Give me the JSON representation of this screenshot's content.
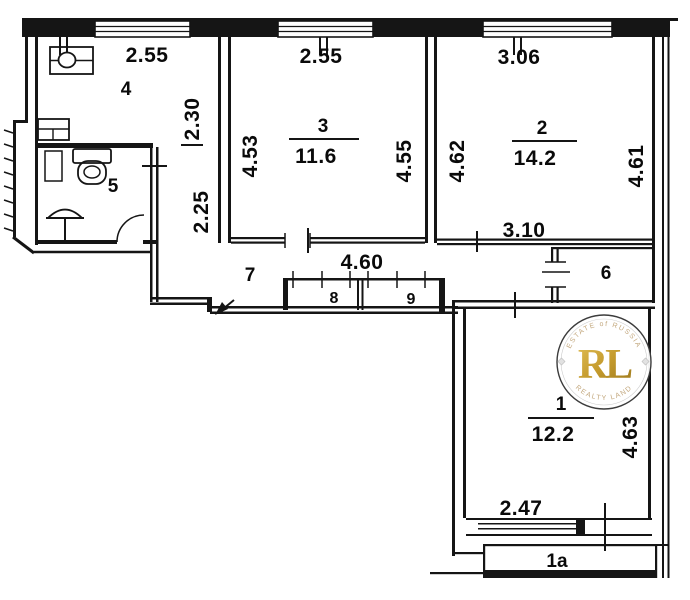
{
  "title": "Apartment floor plan",
  "rooms": [
    {
      "number": "4",
      "width": "2.55",
      "depth": "2.30"
    },
    {
      "number": "3",
      "area": "11.6",
      "width": "2.55",
      "side_left": "4.53",
      "side_right": "4.55"
    },
    {
      "number": "2",
      "area": "14.2",
      "width": "3.06",
      "side_left": "4.62",
      "side_right": "4.61",
      "width_bottom": "3.10"
    },
    {
      "number": "5"
    },
    {
      "number": "7",
      "length": "4.60",
      "width": "2.25"
    },
    {
      "number": "8"
    },
    {
      "number": "9"
    },
    {
      "number": "6"
    },
    {
      "number": "1",
      "area": "12.2",
      "width_bottom": "2.47",
      "side_right": "4.63"
    },
    {
      "number": "1a"
    }
  ],
  "watermark": {
    "initials": "RL",
    "arc_top": "ESTATE of RUSSIA",
    "arc_bottom": "REALTY LAND",
    "gold": "#c19a2e"
  }
}
